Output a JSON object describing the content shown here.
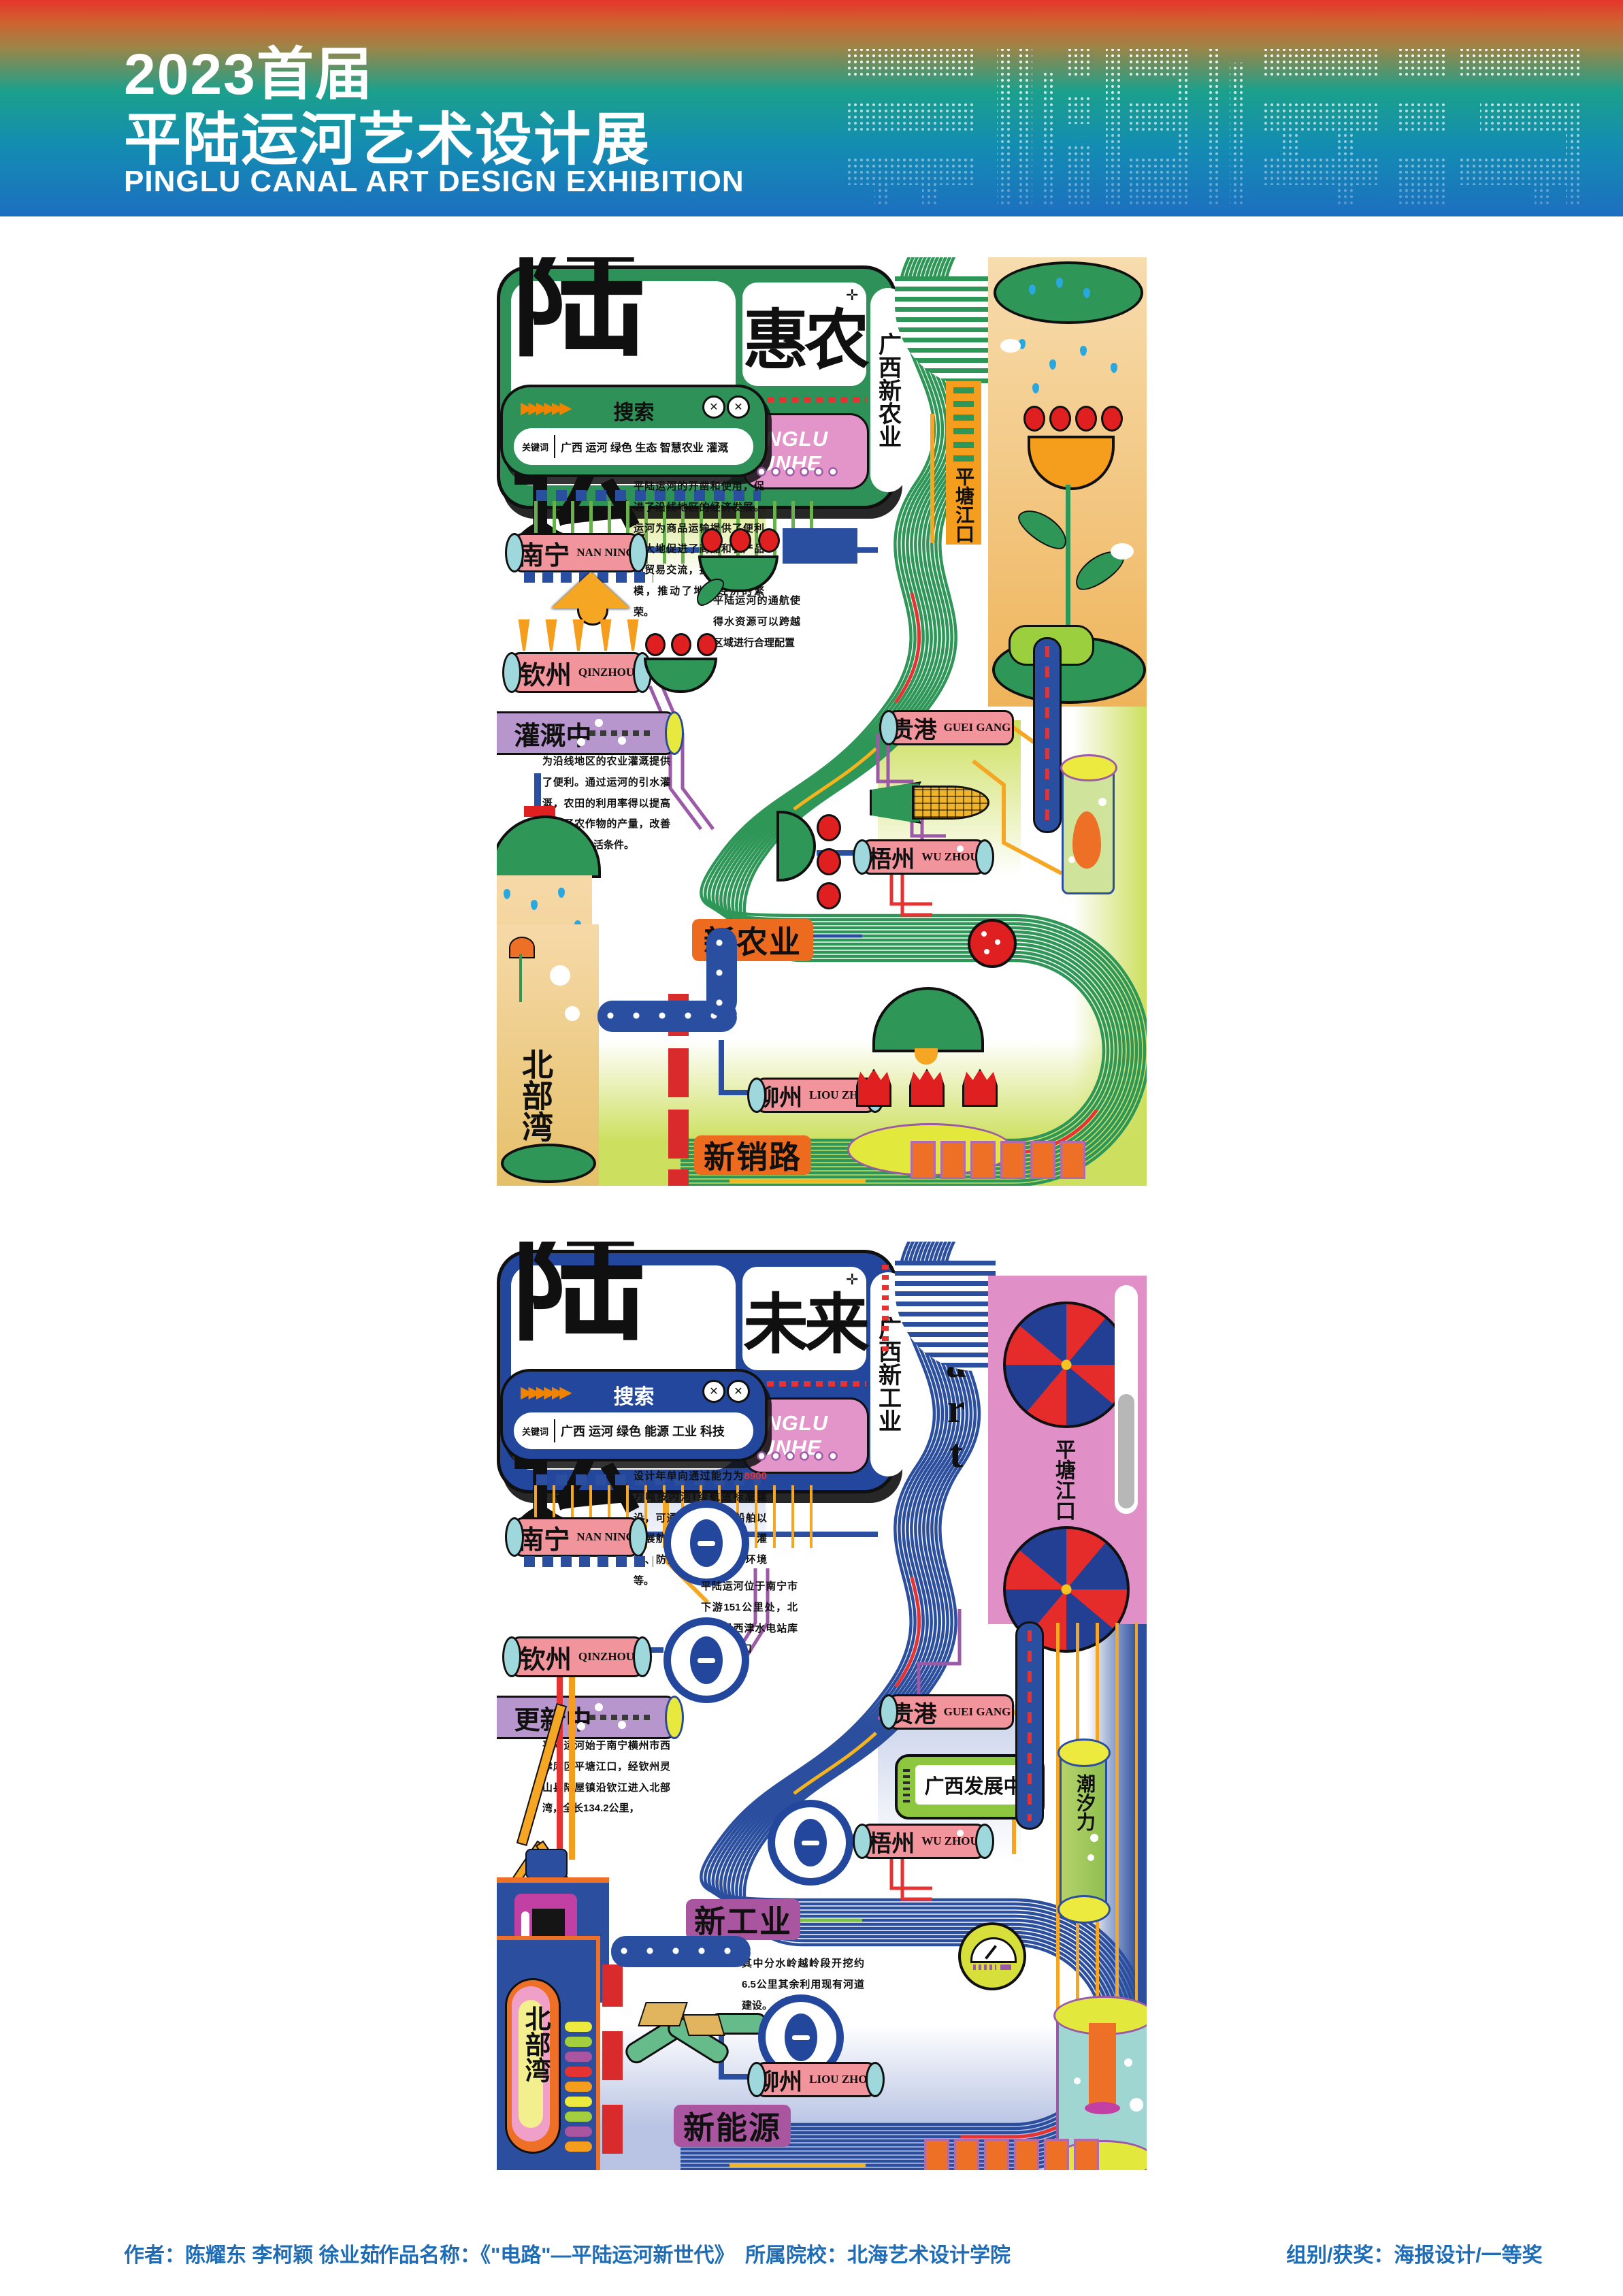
{
  "header": {
    "year_title": "2023首届",
    "cn_title": "平陆运河艺术设计展",
    "en_title": "PINGLU CANAL ART DESIGN EXHIBITION",
    "deco_text": "平陆运河",
    "accent_colors": {
      "red": "#e5352b",
      "teal": "#1ba08c",
      "blue": "#1d6fc0"
    }
  },
  "poster1": {
    "title_main": "陆运",
    "title_sub": "惠农",
    "title_side": "广西新农业",
    "title_tag": "PINGLU YUNHE",
    "start_label": "start",
    "pingtang_label": "平塘江口",
    "beibu_label": "北部湾",
    "search_label": "搜索",
    "keyword_label": "关键词",
    "keywords": "广西 运河 绿色 生态 智慧农业 灌溉",
    "close_icon": "✕",
    "arrows": "▶▶▶▶▶▶",
    "intro_text": "平陆运河的开凿和使用，促进了沿线地区的经济发展。运河为商品运输提供了便利极大地促进了商品和农产品的贸易交流，扩大了市场规模，推动了地区经济的繁荣。",
    "note_text": "平陆运河的通航使得水资源可以跨越区域进行合理配置",
    "irrigation_label": "灌溉中",
    "irrigation_text": "为沿线地区的农业灌溉提供了便利。通过运河的引水灌溉，农田的利用率得以提高增加了农作物的产量，改善了农民的生活条件。",
    "tag_agriculture": "新农业",
    "tag_sales": "新销路",
    "cities": [
      {
        "name": "南宁",
        "en": "NAN NING"
      },
      {
        "name": "钦州",
        "en": "QINZHOU"
      },
      {
        "name": "贵港",
        "en": "GUEI GANG"
      },
      {
        "name": "梧州",
        "en": "WU ZHOU"
      },
      {
        "name": "柳州",
        "en": "LIOU ZHOU"
      }
    ],
    "colors": {
      "main": "#2e9657",
      "bg": "#cddf5e",
      "label": "#ed6b1f",
      "cylinder": "#f2949c"
    }
  },
  "poster2": {
    "title_main": "陆运",
    "title_sub": "未来",
    "title_side": "广西新工业",
    "title_tag": "PINGLU YUNHE",
    "start_label": "start",
    "pingtang_label": "平塘江口",
    "beibu_label": "北部湾",
    "search_label": "搜索",
    "keyword_label": "关键词",
    "keywords": "广西 运河 绿色 能源 工业 科技",
    "close_icon": "✕",
    "arrows": "▶▶▶▶▶▶",
    "stats_text_1": "设计年单向通过能力为",
    "stats_num_1": "8900",
    "stats_text_2": "万吨按内河Ⅰ级航道标准建设，可通航",
    "stats_num_2": "5000",
    "stats_text_3": "吨级船舶以发展航运为主结合供水、灌溉、防洪、改善水生态环境等。",
    "note_text": "平陆运河位于南宁市下游151公里处，北起横县西津水电站库区平塘江口",
    "update_label": "更新中",
    "update_text": "平陆运河始于南宁横州市西津库区平塘江口，经钦州灵山县陆屋镇沿钦江进入北部湾，全长134.2公里，",
    "dig_text": "其中分水岭越岭段开挖约6.5公里其余利用现有河道建设。",
    "dev_label": "广西发展中",
    "tide_label": "潮汐力",
    "tag_industry": "新工业",
    "tag_energy": "新能源",
    "cities": [
      {
        "name": "南宁",
        "en": "NAN NING"
      },
      {
        "name": "钦州",
        "en": "QINZHOU"
      },
      {
        "name": "贵港",
        "en": "GUEI GANG"
      },
      {
        "name": "梧州",
        "en": "WU ZHOU"
      },
      {
        "name": "柳州",
        "en": "LIOU ZHOU"
      }
    ],
    "colors": {
      "main": "#27479e",
      "bg": "#c9d2ea",
      "label": "#a9559f",
      "cylinder": "#f2949c"
    }
  },
  "footer": {
    "authors": "作者：陈耀东 李柯颖 徐业茹",
    "work_label": "作品名称：《\"电路\"—平陆运河新世代》",
    "school": "所属院校：北海艺术设计学院",
    "award": "组别/获奖：海报设计/一等奖"
  }
}
